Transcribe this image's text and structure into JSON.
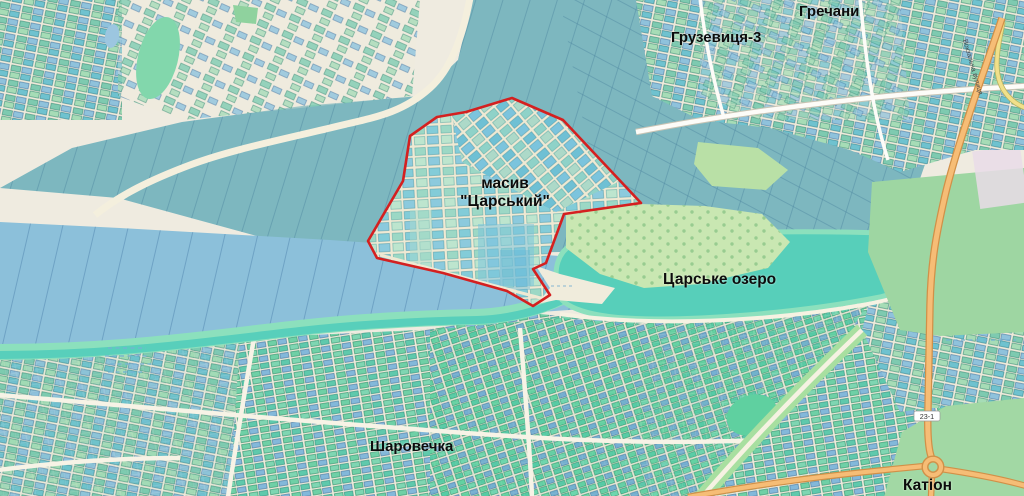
{
  "map": {
    "labels": {
      "city_top_right": "Гречани",
      "district_top": "Грузевиця-3",
      "massif_line1": "масив",
      "massif_line2": "\"Царський\"",
      "lake": "Царське озеро",
      "village_bottom": "Шаровечка",
      "area_bottom_right": "Катіон",
      "street_right": "Вокзальна вулиця",
      "road_ref": "23-1"
    },
    "colors": {
      "background": "#efebe0",
      "field_teal": "#7db7bf",
      "field_blue": "#8cc0da",
      "water_lake": "#57cfba",
      "bank_green": "#8ce0bd",
      "massif_base": "#d9ecd3",
      "park_green": "#c9e7b2",
      "boundary_red": "#d42020",
      "road_orange": "#f6bd76",
      "road_orange_casing": "#d19048",
      "label_text": "#0c0c0c"
    }
  }
}
